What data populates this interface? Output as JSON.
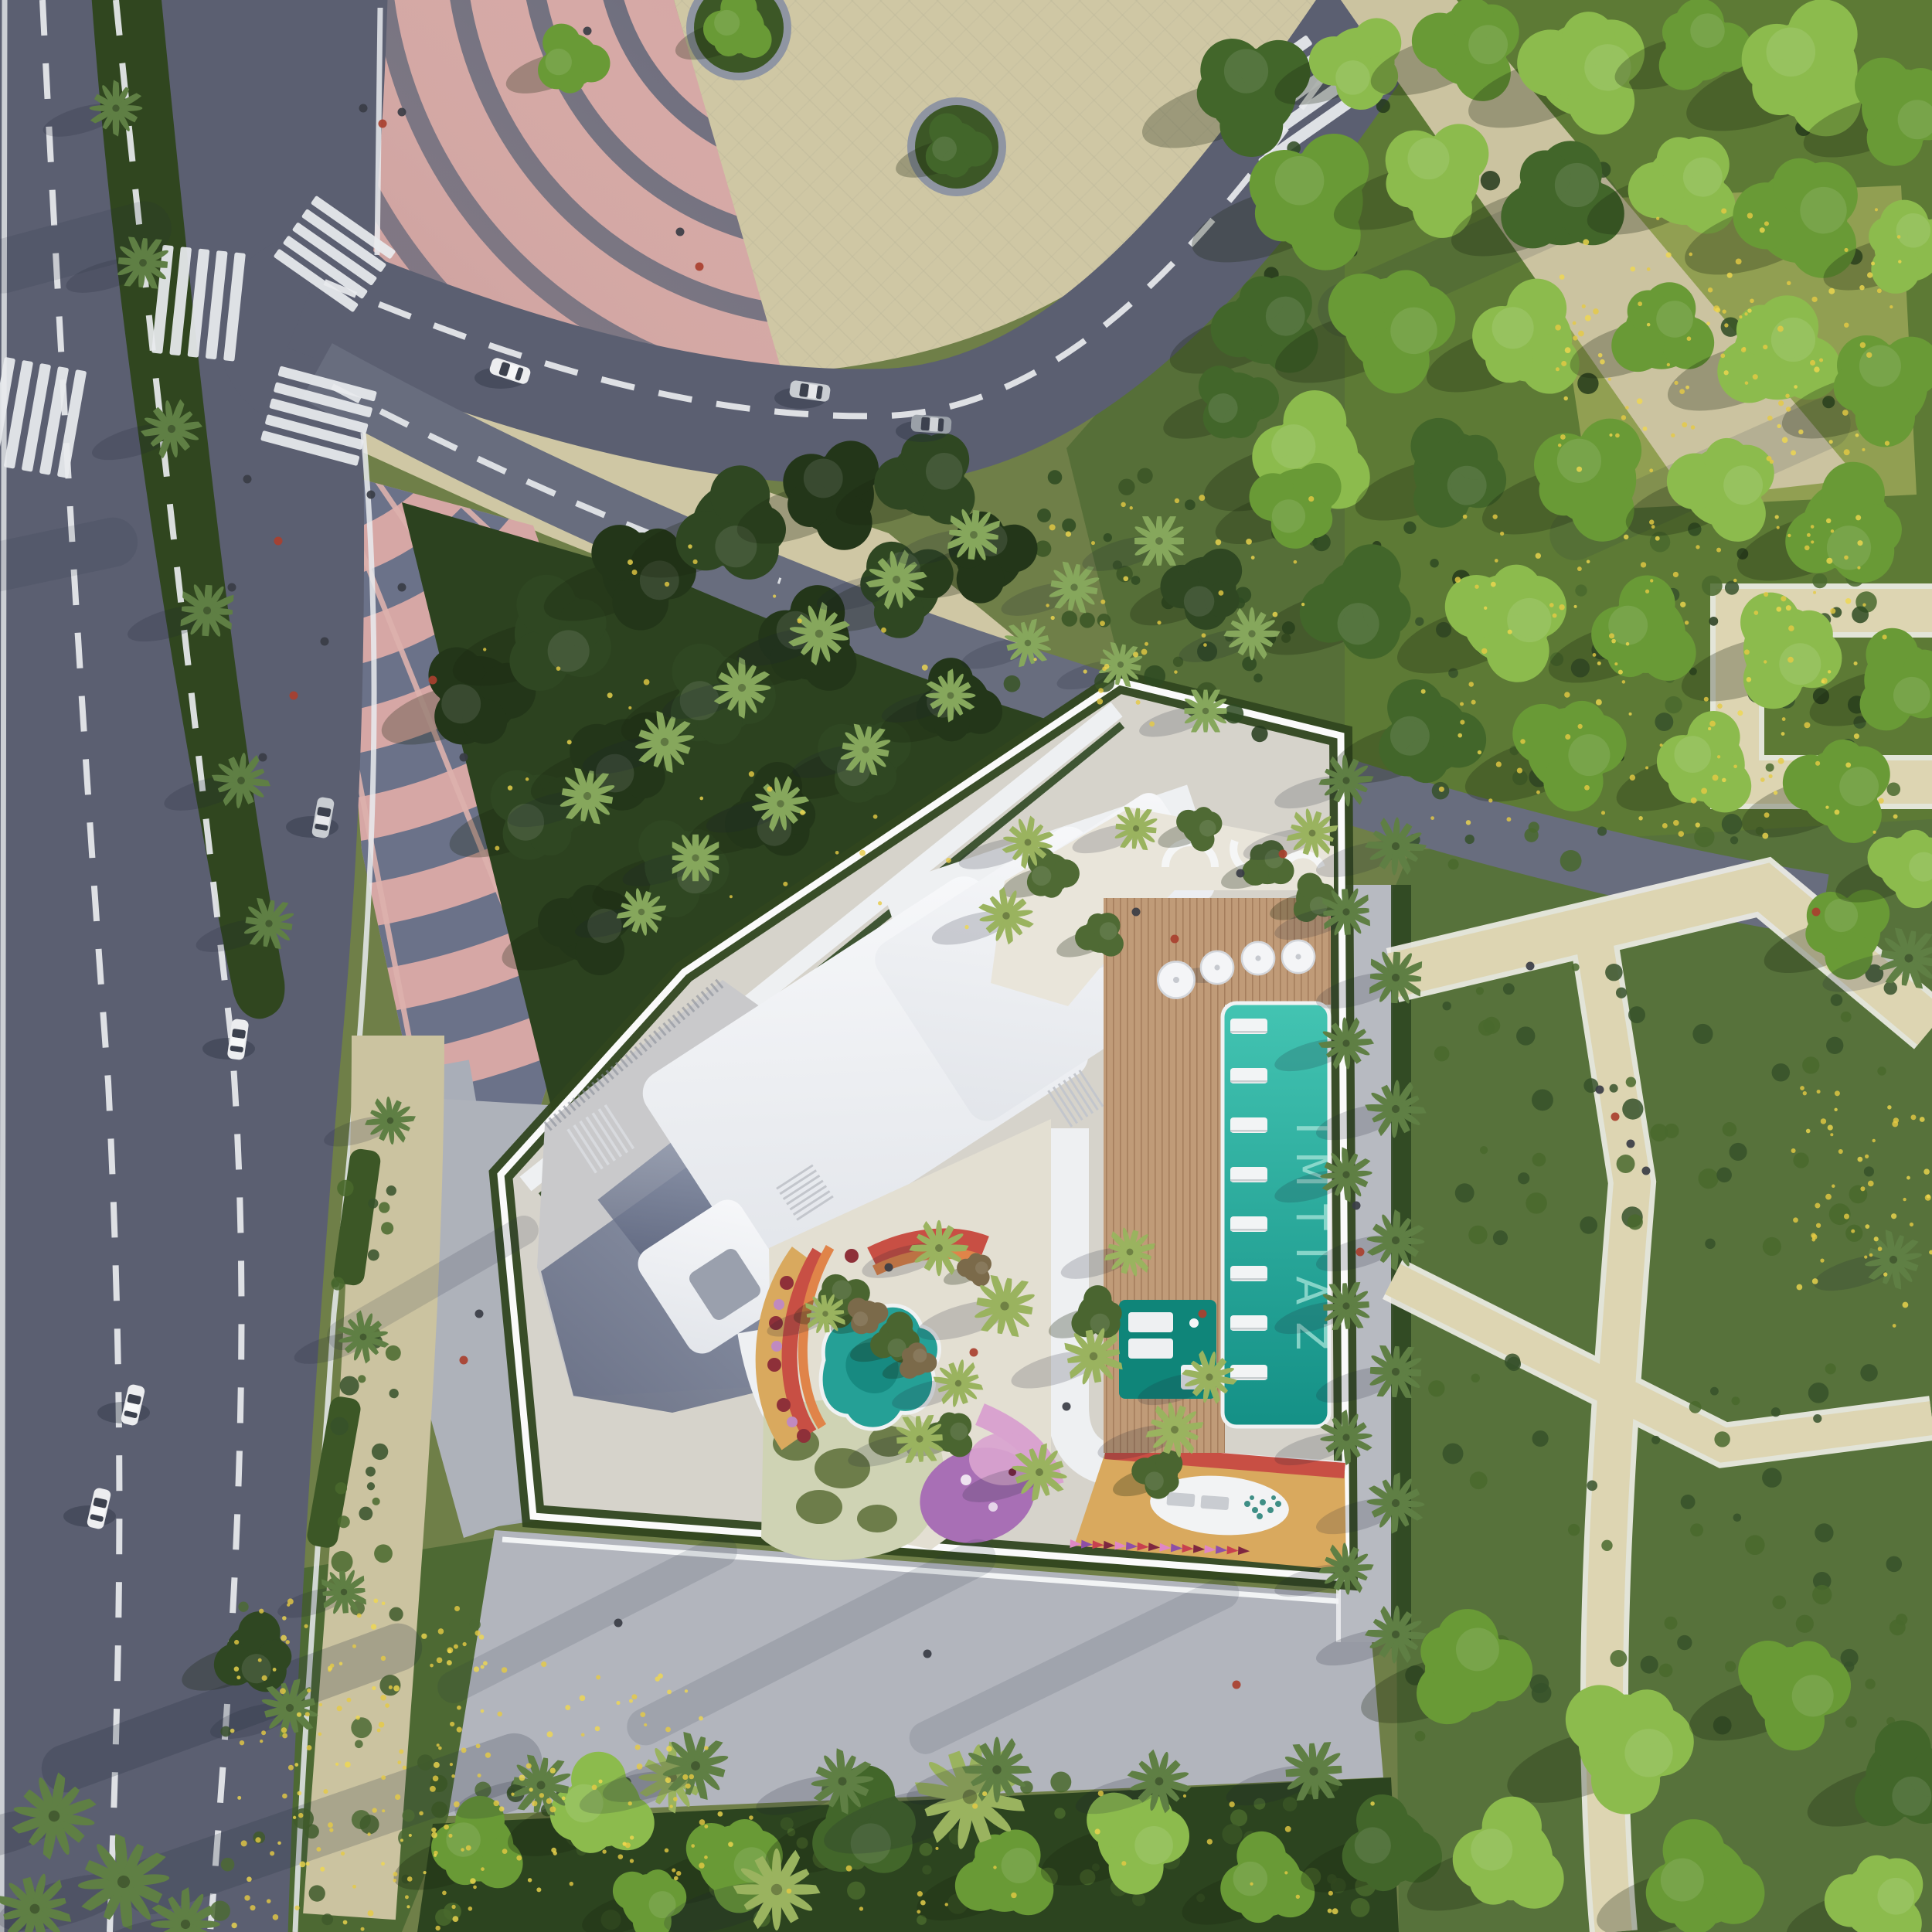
{
  "scene": {
    "description": "Aerial top-down architectural rendering of a residential block with rooftop pool, children's courtyard, pink arc plaza, roads and park landscaping",
    "branding": {
      "pool_deck_label": "IMTIAZ"
    },
    "counts": {
      "cars_visible": 7,
      "crosswalks": 5,
      "pool_umbrellas": 4,
      "in_pool_loungers": 8,
      "pennant_flags": 16
    },
    "landmarks": [
      "curved pink plaza with concentric arc paving",
      "fan shaped amphitheater steps",
      "tree lined boulevard with median palms",
      "white rooftop with amenity terraces",
      "turquoise lap pool with in-pool loungers",
      "children's courtyard with teal splash pad",
      "pedestrian spine with palm allee",
      "wildflower meadow",
      "dense park tree canopy"
    ],
    "colors": {
      "grass-base": "#6f7f48",
      "park-under": "#5d7a35",
      "garden-right": "#57723b",
      "meadow": "#4d6933",
      "flower-yellow": "#e6cb43",
      "hedge": "#30461f",
      "tree-dark": "#233619",
      "tree-dark2": "#2f4722",
      "tree-bright": "#8cbb4d",
      "tree-mid": "#699a36",
      "tree-deep": "#42662a",
      "palm-light": "#9ab35f",
      "palm-olive": "#86a75c",
      "palm-dusty": "#5f7f44",
      "road": "#5b5f71",
      "lane": "#686d7e",
      "marking": "#e9ebee",
      "plaza-pink": "#d6a7a5",
      "plaza-pink-light": "#ddb2ad",
      "plaza-arc": "#5f6478",
      "fan-slate": "#6b7289",
      "sidewalk-beige": "#cbc3a0",
      "plaza-beige": "#cfc7a4",
      "pavement-gray": "#b2b5bd",
      "pavement-warm": "#a9aeb8",
      "site-pale": "#d6d3cb",
      "roof-white": "#f3f4f6",
      "terrace-gray": "#c9c9cb",
      "terrace-slate": "#77809a",
      "terrace-cream": "#e9e5da",
      "deck-wood": "#c8a27e",
      "pool-teal": "#2cb3a4",
      "pool-deep": "#17998e",
      "pool-dark-platform": "#0f8579",
      "pool-text": "#9fe2d6",
      "splash-teal": "#25a096",
      "courtyard-ochre": "#d9a95e",
      "courtyard-red": "#c84f44",
      "courtyard-orange": "#e08449",
      "playground-purple": "#a86fb5",
      "playground-pink": "#d9a3cf",
      "sage": "#cfd3b4",
      "sage-hump": "#6d7d4a",
      "car-silver": "#c9cdd2",
      "car-white": "#ecedef",
      "car-gray": "#9aa0a8",
      "people-dark": "#3a3d45",
      "people-red": "#a9402f"
    },
    "pennant_palette": [
      "#e087c5",
      "#8d4fa8",
      "#c8404f",
      "#7e2740"
    ]
  }
}
